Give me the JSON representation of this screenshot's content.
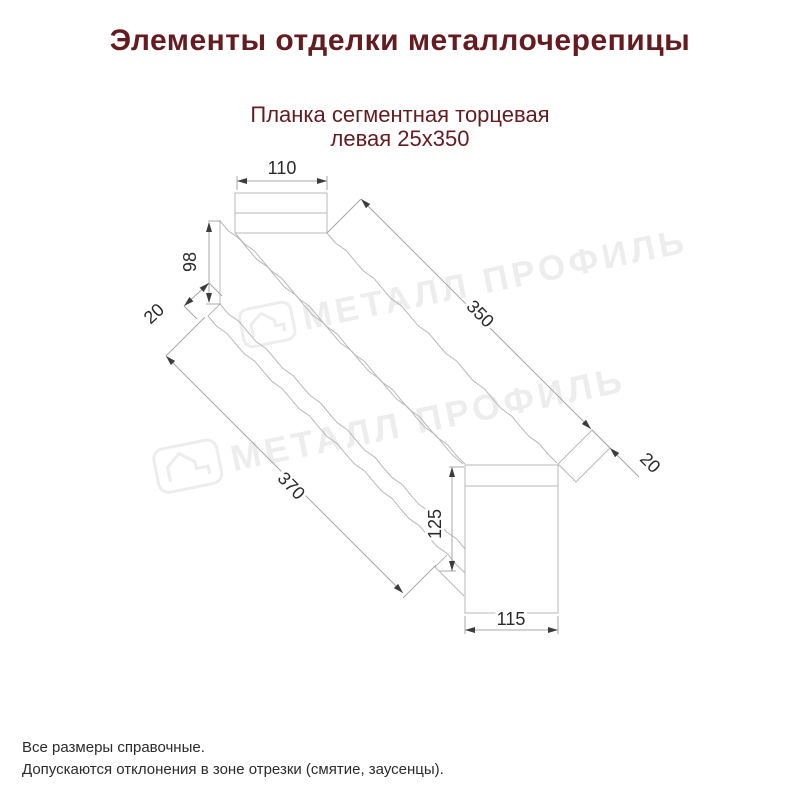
{
  "title": "Элементы отделки металлочерепицы",
  "subtitle": {
    "line1": "Планка сегментная торцевая",
    "line2": "левая 25х350"
  },
  "drawing": {
    "name": "Планка сегментная торцевая левая 25х350",
    "dim_top_width": "110",
    "dim_left_height": "98",
    "dim_left_fold": "20",
    "dim_top_length": "350",
    "dim_right_fold": "20",
    "dim_bottom_length": "370",
    "dim_end_height": "125",
    "dim_end_width": "115"
  },
  "watermark": {
    "text": "МЕТАЛЛ ПРОФИЛЬ",
    "logo_icon": "house-logo-icon"
  },
  "footer": {
    "line1": "Все размеры справочные.",
    "line2": "Допускаются отклонения в зоне отрезки (смятие, заусенцы)."
  },
  "colors": {
    "heading": "#641c20",
    "drawing_line": "#b9b9b9",
    "dimension_line": "#a8a8a8",
    "dimension_text": "#2a2a2a",
    "arrow": "#3c3c3c",
    "watermark": "#d2d2d2",
    "background": "#ffffff"
  }
}
